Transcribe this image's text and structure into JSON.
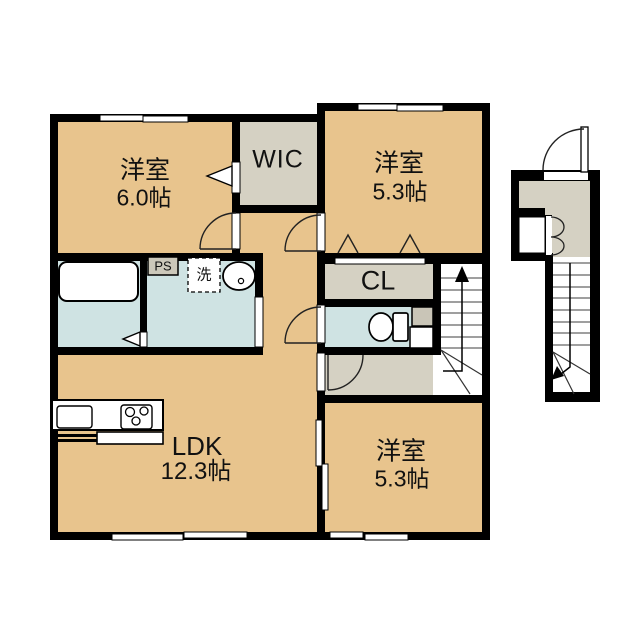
{
  "plan": {
    "rooms": {
      "bedroom_nw": {
        "name": "洋室",
        "size": "6.0帖"
      },
      "wic": {
        "name": "WIC"
      },
      "bedroom_ne": {
        "name": "洋室",
        "size": "5.3帖"
      },
      "closet": {
        "name": "CL"
      },
      "ldk": {
        "name": "LDK",
        "size": "12.3帖"
      },
      "bedroom_se": {
        "name": "洋室",
        "size": "5.3帖"
      }
    },
    "fixtures": {
      "pipe_space": "PS",
      "laundry": "洗"
    },
    "colors": {
      "bg": "#ffffff",
      "room": "#e8c48d",
      "closet": "#d5d1c3",
      "wet": "#cfe3e3",
      "wall": "#000000",
      "line": "#333333",
      "tread": "#666666"
    }
  }
}
